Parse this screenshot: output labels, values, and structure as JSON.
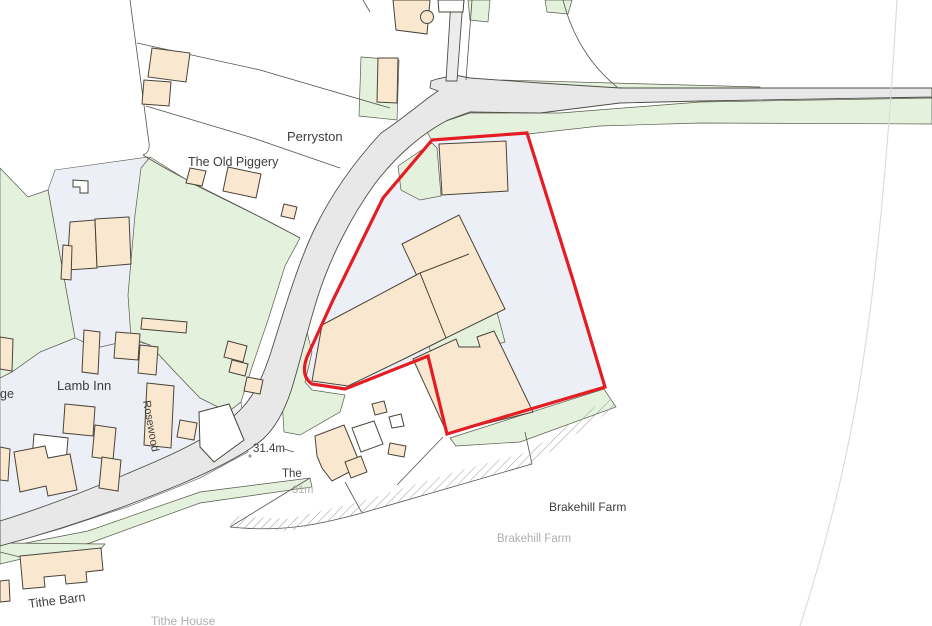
{
  "map": {
    "title": "Site location plan - Brakehill Farm",
    "canvas": {
      "w": 932,
      "h": 626,
      "bg": "#ffffff"
    },
    "colors": {
      "building_fill": "#fae7d0",
      "building_stroke": "#494439",
      "white_building_fill": "#ffffff",
      "road_fill": "#e8e8e8",
      "drive_fill": "#ececec",
      "road_stroke": "#4e4e46",
      "green_fill": "#e4f1dc",
      "green_stroke": "#5a5a4d",
      "parcel_fill": "#edeff6",
      "parcel_stroke": "#57574c",
      "line_stroke": "#53534b",
      "faint_line": "#dadada",
      "red_boundary": "#e41d25",
      "label_dark": "#3d3d3d",
      "label_grey": "#b0b0b0",
      "hatch_stroke": "#9a9a9a"
    },
    "parcels": [
      {
        "name": "parcel-driveway",
        "pts": "55,170 148,157 131,340 96,348 75,338 48,190"
      },
      {
        "name": "parcel-housing-block",
        "pts": "0,378 12,372 40,352 75,338 96,348 131,340 150,345 175,372 200,398 228,412 241,402 248,452 200,478 130,506 60,529 0,546"
      }
    ],
    "green": [
      {
        "name": "green-verge-north-right",
        "pts": "502,80 760,87 760,91 502,85"
      },
      {
        "name": "green-verge-south-right",
        "pts": "425,128 470,113 560,113 700,102 932,98 932,124 700,123 600,126 528,134 432,141"
      },
      {
        "name": "green-mid-belt",
        "pts": "150,157 195,185 252,213 300,238 285,266 268,320 251,370 241,402 228,412 200,398 175,372 150,345 131,338 128,295 135,215 141,168"
      },
      {
        "name": "green-field-left",
        "pts": "0,168 28,197 48,190 75,338 40,352 12,372 0,378"
      },
      {
        "name": "green-verge-east-bend",
        "pts": "290,324 304,320 312,352 305,382 312,390 345,395 340,412 300,435 284,432 282,400 288,360"
      },
      {
        "name": "green-verge-bottom-left",
        "pts": "0,548 88,531 200,492 310,478 312,487 200,503 90,543 0,564"
      },
      {
        "name": "green-tithe-strip",
        "pts": "0,543 105,544 101,549 20,557 0,552"
      },
      {
        "name": "green-strip-red-south",
        "pts": "450,438 604,389 616,407 520,442 456,446"
      },
      {
        "name": "green-inside-north",
        "pts": "398,166 432,143 437,148 441,196 420,200 401,190"
      },
      {
        "name": "green-inside-mid",
        "pts": "425,334 497,312 505,342 470,352 432,356"
      },
      {
        "name": "green-top-patch-1",
        "pts": "468,0 490,0 488,22 470,20"
      },
      {
        "name": "green-top-patch-2",
        "pts": "545,0 572,0 568,14 547,12"
      },
      {
        "name": "green-drive-parcel",
        "pts": "361,57 399,60 397,120 359,116"
      }
    ],
    "roads": [
      {
        "name": "road-main",
        "d": "M455,75 L437,79 L431,81 L430,88 L438,91 C424,100 404,118 381,133 C356,160 333,191 315,228 C298,263 284,311 271,352 C263,377 254,395 243,407 C223,429 193,445 159,460 C111,481 49,506 0,521 L0,546 C56,531 121,509 181,484 C216,469 246,454 263,439 C275,428 284,412 291,391 C299,366 307,331 318,296 C331,256 351,217 374,185 C395,157 421,134 448,120 L470,112 L540,113 L620,103 L700,101 L932,97 L932,88 L700,88 L620,88 L540,83 L470,78 Z",
        "fill": "road"
      },
      {
        "name": "road-drive",
        "d": "M451,0 L463,0 L457,81 L446,81 Z",
        "fill": "drive"
      }
    ],
    "lines": [
      {
        "name": "line-drive-kerb",
        "d": "M472,0 L466,80",
        "w": 0.8
      },
      {
        "name": "line-west-boundary",
        "d": "M130,0 L149,143 C150,151 146,154 143,155",
        "w": 0.8
      },
      {
        "name": "line-piggery-north",
        "d": "M137,43 L260,70 L390,108",
        "w": 0.8
      },
      {
        "name": "line-piggery-mid",
        "d": "M146,106 L253,138 L340,168",
        "w": 0.8
      },
      {
        "name": "line-piggery-curve",
        "d": "M143,155 C190,184 240,205 300,238",
        "w": 0.8
      },
      {
        "name": "line-perryston-east",
        "d": "M563,0 C572,35 590,65 617,87",
        "w": 0.8
      },
      {
        "name": "line-top-left-stub",
        "d": "M363,0 L370,12",
        "w": 0.8
      },
      {
        "name": "line-farm-north",
        "d": "M397,485 L443,437",
        "w": 0.8
      },
      {
        "name": "line-farm-west",
        "d": "M345,482 L362,513",
        "w": 0.8
      },
      {
        "name": "line-farm-south",
        "d": "M362,513 L532,464",
        "w": 0.8
      },
      {
        "name": "line-farm-east",
        "d": "M532,464 L525,432",
        "w": 0.8
      },
      {
        "name": "line-track-curve",
        "d": "M230,527 C285,533 325,523 362,513",
        "w": 0.8
      },
      {
        "name": "line-track-west",
        "d": "M310,478 L230,527",
        "w": 0.8
      },
      {
        "name": "line-31m-tick",
        "d": "M284,449 L294,452",
        "w": 0.7
      }
    ],
    "faint_lines": [
      {
        "name": "line-right-field-faint",
        "d": "M897,0 C889,140 876,300 853,420 C838,500 818,570 800,626",
        "w": 1.1
      }
    ],
    "hatch_band": {
      "name": "track-hatch-band",
      "pts": "232,516 288,519 360,502 455,472 528,452 608,398 616,407 532,464 462,483 362,513 290,531 230,528"
    },
    "red_boundary": {
      "name": "site-boundary",
      "d": "M432,140 L527,133 L573,280 L605,387 L470,427 L447,434 L428,356 L345,389 L312,384 Q300,376 307,357 L333,300 L383,198 Z",
      "width": 3.2
    },
    "buildings": [
      {
        "name": "building-top-arc",
        "pts": "393,0 430,0 427,34 396,30"
      },
      {
        "name": "building-drive-side",
        "pts": "378,58 398,58 397,103 377,102"
      },
      {
        "name": "building-nw-1",
        "pts": "152,48 190,53 186,82 148,77"
      },
      {
        "name": "building-nw-2",
        "pts": "144,80 171,82 169,106 142,104"
      },
      {
        "name": "building-piggery-small",
        "pts": "190,168 206,171 202,186 186,183"
      },
      {
        "name": "building-piggery-large",
        "pts": "228,167 261,174 256,198 223,191"
      },
      {
        "name": "building-piggery-east",
        "pts": "284,204 297,207 294,219 281,216"
      },
      {
        "name": "building-lamb-out-1",
        "pts": "70,222 95,220 97,268 67,270"
      },
      {
        "name": "building-lamb-out-2",
        "pts": "95,219 129,217 131,264 97,267"
      },
      {
        "name": "building-lamb-tab",
        "pts": "63,245 72,246 71,280 61,279"
      },
      {
        "name": "building-lane-top",
        "pts": "84,330 100,332 98,374 82,372"
      },
      {
        "name": "building-lane-row",
        "pts": "142,318 187,322 186,333 141,329"
      },
      {
        "name": "building-lane-2",
        "pts": "65,404 95,407 93,436 63,433"
      },
      {
        "name": "building-lane-3",
        "pts": "95,425 116,428 113,460 92,457"
      },
      {
        "name": "building-lane-4",
        "pts": "102,457 121,460 118,491 99,488"
      },
      {
        "name": "building-left-edge",
        "pts": "0,337 13,339 12,371 0,369"
      },
      {
        "name": "building-rosewood-house",
        "pts": "147,383 174,386 171,448 144,445"
      },
      {
        "name": "building-cluster-1",
        "pts": "116,332 140,334 138,360 114,358"
      },
      {
        "name": "building-cluster-2",
        "pts": "140,345 158,347 156,375 138,373"
      },
      {
        "name": "building-wedge-1",
        "pts": "228,341 247,346 243,362 224,357"
      },
      {
        "name": "building-wedge-2",
        "pts": "232,360 248,364 245,376 229,372"
      },
      {
        "name": "building-bend-small",
        "pts": "247,377 263,380 260,394 244,391"
      },
      {
        "name": "building-bend-small-2",
        "pts": "180,420 197,423 194,440 177,437"
      },
      {
        "name": "building-corner-house",
        "pts": "14,452 45,446 48,458 70,454 77,490 48,496 46,486 20,492"
      },
      {
        "name": "building-left-partial",
        "pts": "0,447 10,449 8,481 0,480"
      },
      {
        "name": "building-farmhouse",
        "pts": "315,436 344,425 349,437 361,466 332,481 322,468 317,456"
      },
      {
        "name": "building-farm-wing",
        "pts": "345,462 361,456 367,472 351,478"
      },
      {
        "name": "building-farm-small",
        "pts": "390,443 406,446 404,457 388,454"
      },
      {
        "name": "building-farm-tab",
        "pts": "372,404 384,401 387,412 375,415"
      },
      {
        "name": "building-tithe-barn",
        "pts": "20,556 101,548 103,570 86,572 87,582 66,584 65,575 44,577 45,587 23,589"
      },
      {
        "name": "building-bottom-edge",
        "pts": "0,581 9,580 10,601 0,602"
      },
      {
        "name": "building-inred-top",
        "pts": "439,144 506,141 508,191 442,195"
      },
      {
        "name": "building-inred-block",
        "pts": "402,244 459,215 505,309 446,338"
      },
      {
        "name": "building-inred-band",
        "pts": "322,325 420,273 446,338 408,357 348,386 312,381"
      },
      {
        "name": "building-inred-lower",
        "pts": "413,359 456,339 459,347 480,347 477,337 494,331 533,412 447,433"
      }
    ],
    "building_lines": [
      {
        "name": "building-inred-divider",
        "d": "M420,273 L469,254"
      }
    ],
    "white_buildings": [
      {
        "name": "white-building-top",
        "pts": "438,0 464,0 463,12 439,12"
      },
      {
        "name": "white-building-notch",
        "pts": "73,180 88,181 88,193 80,193 80,187 73,187"
      },
      {
        "name": "white-building-lamb-nw",
        "pts": "34,434 68,438 66,463 32,459"
      },
      {
        "name": "white-building-bend-house",
        "pts": "199,412 229,404 244,440 214,462 200,447"
      },
      {
        "name": "white-building-farm-annex",
        "pts": "352,428 374,421 383,444 361,452"
      },
      {
        "name": "white-building-farm-small",
        "pts": "389,417 401,414 404,426 392,428"
      }
    ],
    "circles": [
      {
        "name": "building-bump",
        "cx": 427,
        "cy": 17,
        "r": 6.5,
        "kind": "building"
      },
      {
        "name": "spot-height-dot",
        "cx": 250,
        "cy": 456,
        "r": 1.6,
        "kind": "dot"
      }
    ],
    "labels": [
      {
        "name": "label-perryston",
        "text": "Perryston",
        "x": 287,
        "y": 141,
        "size": 13,
        "color": "dark",
        "rot": 0
      },
      {
        "name": "label-old-piggery",
        "text": "The Old Piggery",
        "x": 188,
        "y": 166,
        "size": 12.5,
        "color": "dark",
        "rot": 0
      },
      {
        "name": "label-lamb-inn",
        "text": "Lamb Inn",
        "x": 57,
        "y": 390,
        "size": 13,
        "color": "dark",
        "rot": 0
      },
      {
        "name": "label-ge",
        "text": "ge",
        "x": 0,
        "y": 398,
        "size": 12.5,
        "color": "dark",
        "rot": 0
      },
      {
        "name": "label-rosewood",
        "text": "Rosewood",
        "x": 143,
        "y": 401,
        "size": 11,
        "color": "dark",
        "rot": 80
      },
      {
        "name": "label-spot-height",
        "text": "31.4m",
        "x": 253,
        "y": 452,
        "size": 11.5,
        "color": "dark",
        "rot": 0
      },
      {
        "name": "label-the",
        "text": "The",
        "x": 282,
        "y": 477,
        "size": 11.5,
        "color": "dark",
        "rot": 0
      },
      {
        "name": "label-31m",
        "text": "31m",
        "x": 292,
        "y": 493,
        "size": 11,
        "color": "grey",
        "rot": 0
      },
      {
        "name": "label-brakehill-farm",
        "text": "Brakehill Farm",
        "x": 549,
        "y": 511,
        "size": 12,
        "color": "dark",
        "rot": 0
      },
      {
        "name": "label-brakehill-farm-grey",
        "text": "Brakehill Farm",
        "x": 497,
        "y": 542,
        "size": 11.5,
        "color": "grey",
        "rot": 0
      },
      {
        "name": "label-tithe-barn",
        "text": "Tithe Barn",
        "x": 29,
        "y": 608,
        "size": 12.5,
        "color": "dark",
        "rot": -7
      },
      {
        "name": "label-tithe-house",
        "text": "Tithe House",
        "x": 151,
        "y": 625,
        "size": 12,
        "color": "grey",
        "rot": 0
      }
    ]
  }
}
